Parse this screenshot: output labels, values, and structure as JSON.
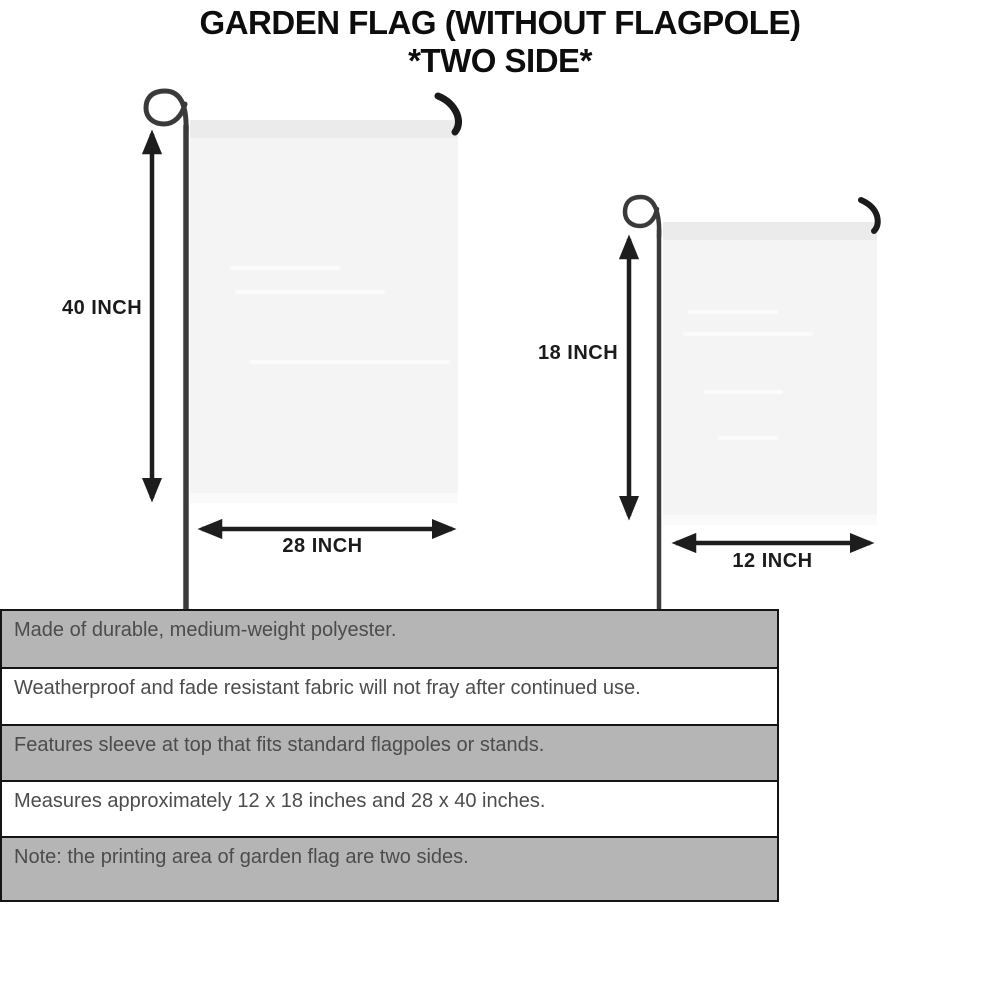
{
  "title": {
    "line1": "GARDEN FLAG (WITHOUT FLAGPOLE)",
    "line2": "*TWO SIDE*"
  },
  "flags": {
    "large": {
      "height_label": "40 INCH",
      "width_label": "28 INCH"
    },
    "small": {
      "height_label": "18 INCH",
      "width_label": "12 INCH"
    }
  },
  "features": [
    "Made of durable, medium-weight polyester.",
    "Weatherproof and fade resistant fabric will not fray after continued use.",
    "Features sleeve at top that fits standard flagpoles or stands.",
    "Measures approximately 12 x 18 inches and 28 x 40 inches.",
    "Note: the printing area of garden flag are two sides."
  ],
  "colors": {
    "background": "#ffffff",
    "title_text": "#0d0d0d",
    "flag_fill": "#f4f4f4",
    "flag_sleeve": "#ebebeb",
    "pole": "#3a3a3a",
    "arrow": "#1d1d1d",
    "table_row_gray": "#b5b5b5",
    "table_row_white": "#ffffff",
    "table_border": "#151515",
    "table_text": "#4c4c4c"
  }
}
